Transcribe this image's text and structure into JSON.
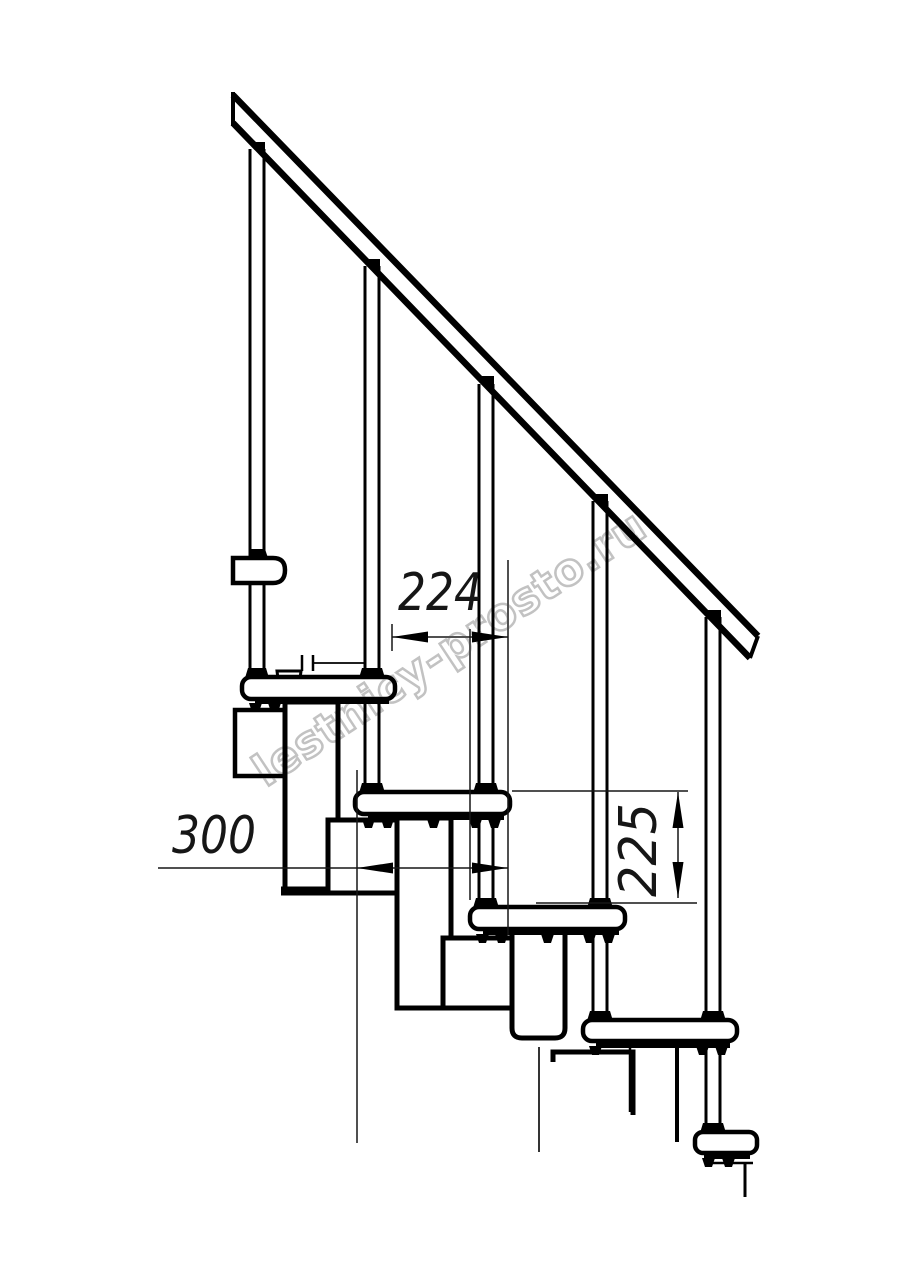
{
  "drawing": {
    "watermark_text": "lestnicy-prosto.ru",
    "dimensions": {
      "going_mm": "224",
      "tread_depth_mm": "300",
      "rise_mm": "225"
    },
    "colors": {
      "line": "#000000",
      "thin_line": "#161616",
      "watermark_outline": "#c2c2c2",
      "background": "#ffffff"
    }
  }
}
